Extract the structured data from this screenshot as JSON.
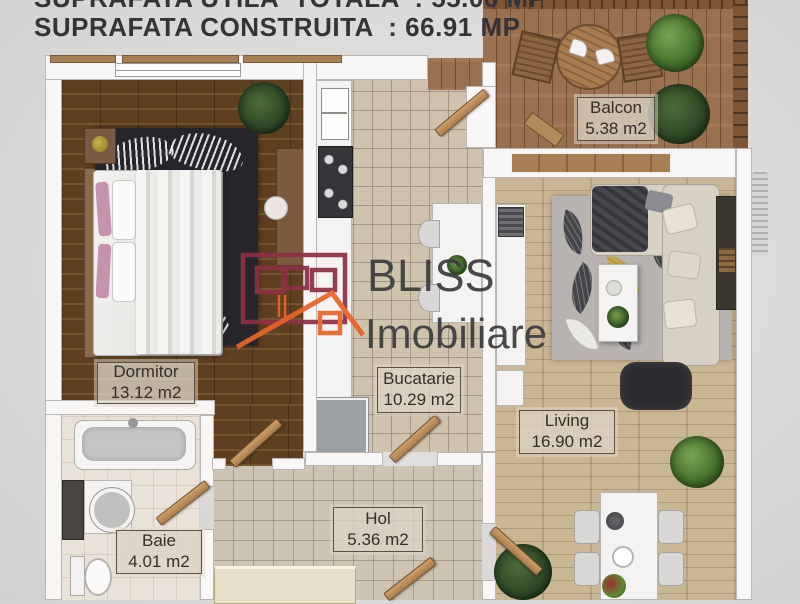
{
  "header": {
    "line1": "SUPRAFATA UTILA  TOTALA  : 55.06 MP",
    "line2": "SUPRAFATA CONSTRUITA  : 66.91 MP"
  },
  "watermark": {
    "brand": "BLISS",
    "subbrand": "Imobiliare"
  },
  "rooms": {
    "dormitor": {
      "name": "Dormitor",
      "area": "13.12 m2"
    },
    "bucatarie": {
      "name": "Bucatarie",
      "area": "10.29 m2"
    },
    "balcon": {
      "name": "Balcon",
      "area": "5.38 m2"
    },
    "living": {
      "name": "Living",
      "area": "16.90 m2"
    },
    "hol": {
      "name": "Hol",
      "area": "5.36 m2"
    },
    "baie": {
      "name": "Baie",
      "area": "4.01 m2"
    }
  },
  "colors": {
    "logo_maroon": "#8e3044",
    "logo_orange": "#e8632c",
    "watermark_text": "#3d3c3c",
    "dark_wood_floor": "#5e3f1f",
    "light_wood_floor": "#c9b693",
    "deck_wood": "#9a7150",
    "tile_floor": "#cfc3ae",
    "wall": "#f8f7f5"
  }
}
